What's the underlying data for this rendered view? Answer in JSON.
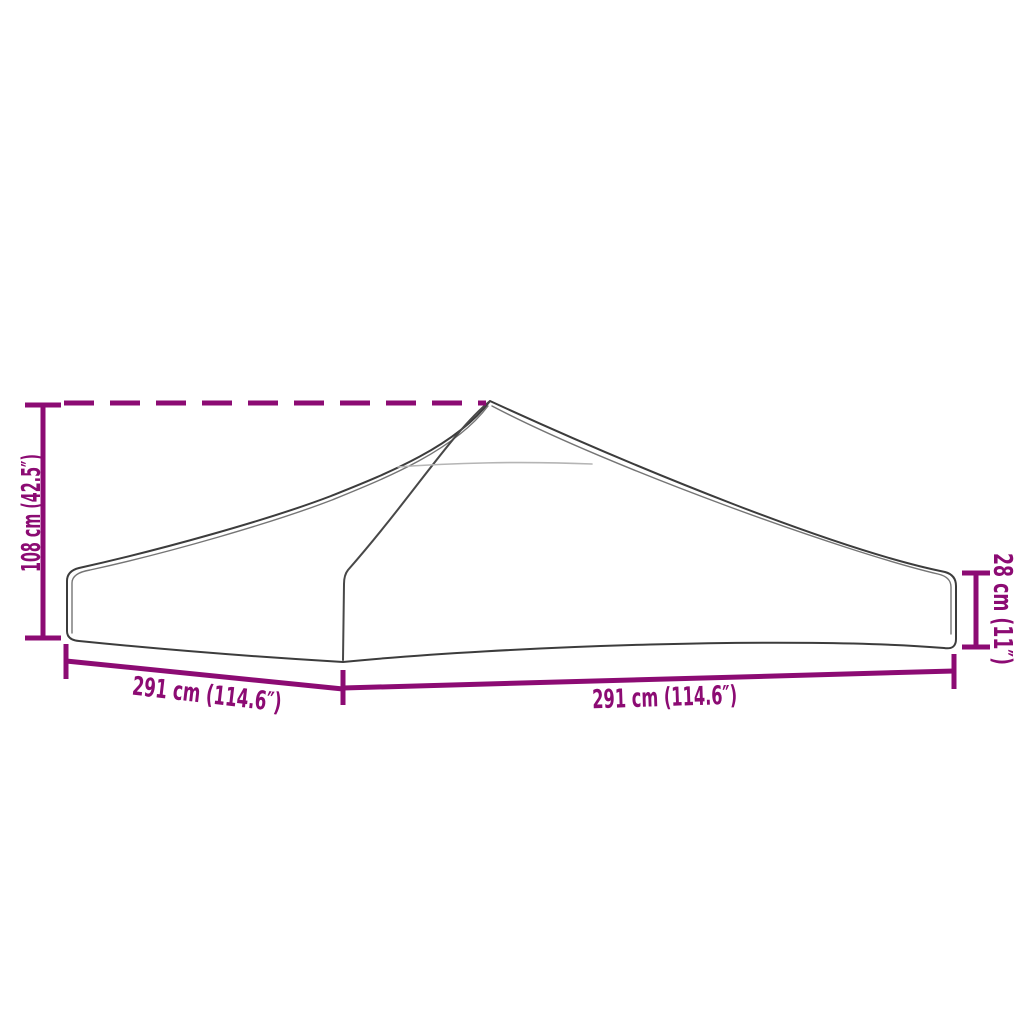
{
  "colors": {
    "accent": "#8C0B73",
    "outline": "#3c3c3c",
    "outline-light": "#757575",
    "seam-faint": "#b5b5b5",
    "background": "#ffffff"
  },
  "diagram": {
    "type": "product-dimension-line-drawing",
    "subject": "party tent / gazebo replacement roof canopy",
    "labels": {
      "peak_height": "108 cm (42.5″)",
      "valance_height": "28 cm (11″)",
      "left_width": "291 cm (114.6″)",
      "right_width": "291 cm (114.6″)"
    }
  }
}
